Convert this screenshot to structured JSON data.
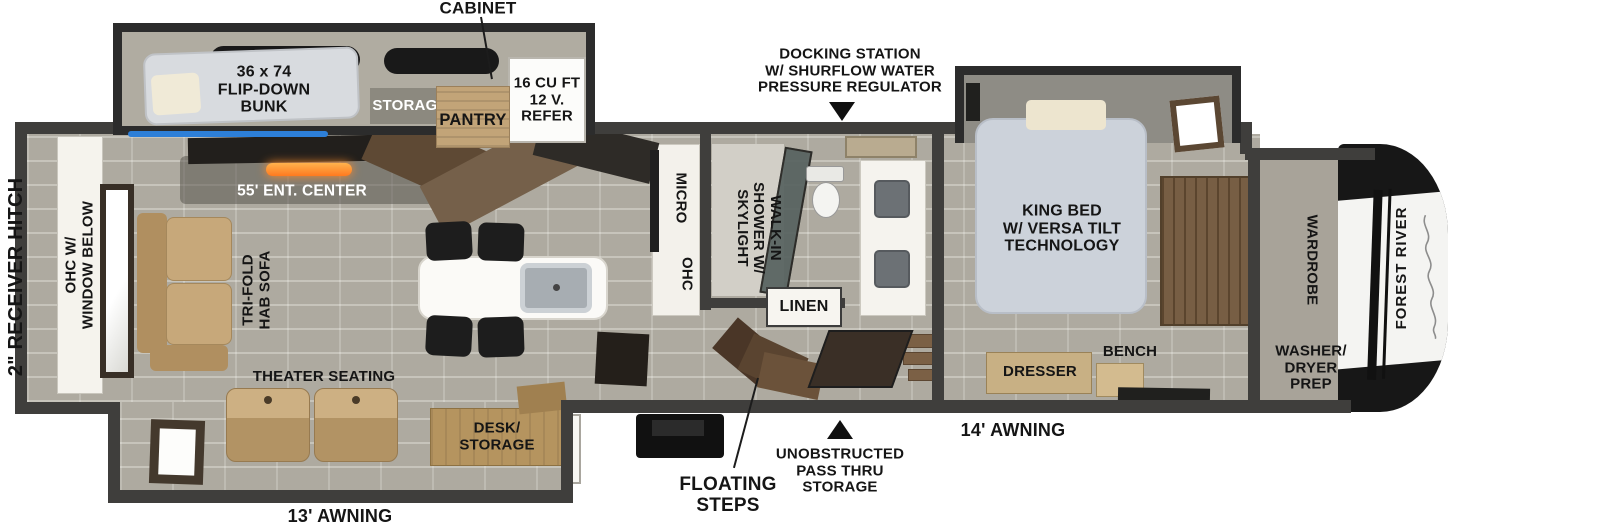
{
  "exterior": {
    "hitch": "2\" RECEIVER HITCH",
    "awning_rear": "13' AWNING",
    "awning_front": "14' AWNING",
    "brand": "FOREST RIVER"
  },
  "callouts": {
    "cabinet": "CABINET",
    "docking_station": "DOCKING STATION\nW/ SHURFLOW WATER\nPRESSURE REGULATOR",
    "floating_steps": "FLOATING\nSTEPS",
    "pass_thru": "UNOBSTRUCTED\nPASS THRU\nSTORAGE"
  },
  "bunk_room": {
    "bunk": "36 x 74\nFLIP-DOWN\nBUNK",
    "storage": "STORAGE",
    "pantry": "PANTRY",
    "refer": "16 CU FT\n12 V.\nREFER"
  },
  "living": {
    "ent_center": "55' ENT. CENTER",
    "ohc_window": "OHC W/\nWINDOW BELOW",
    "sofa": "TRI-FOLD\nHAB SOFA",
    "theater": "THEATER SEATING",
    "desk": "DESK/\nSTORAGE"
  },
  "kitchen": {
    "micro": "MICRO",
    "ohc": "OHC"
  },
  "bath": {
    "shower": "WALK-IN\nSHOWER W/\nSKYLIGHT",
    "linen": "LINEN"
  },
  "bedroom": {
    "king_bed": "KING BED\nW/ VERSA TILT\nTECHNOLOGY",
    "dresser": "DRESSER",
    "bench": "BENCH"
  },
  "front": {
    "wardrobe": "WARDROBE",
    "washer": "WASHER/\nDRYER\nPREP"
  },
  "colors": {
    "wall": "#3f3e3c",
    "accent_led": "#2d7fd8",
    "fireplace": "#ff8c2a",
    "wood": "#6f5438",
    "sofa_tan": "#c7a87a",
    "bed_grey": "#ccd2da"
  }
}
